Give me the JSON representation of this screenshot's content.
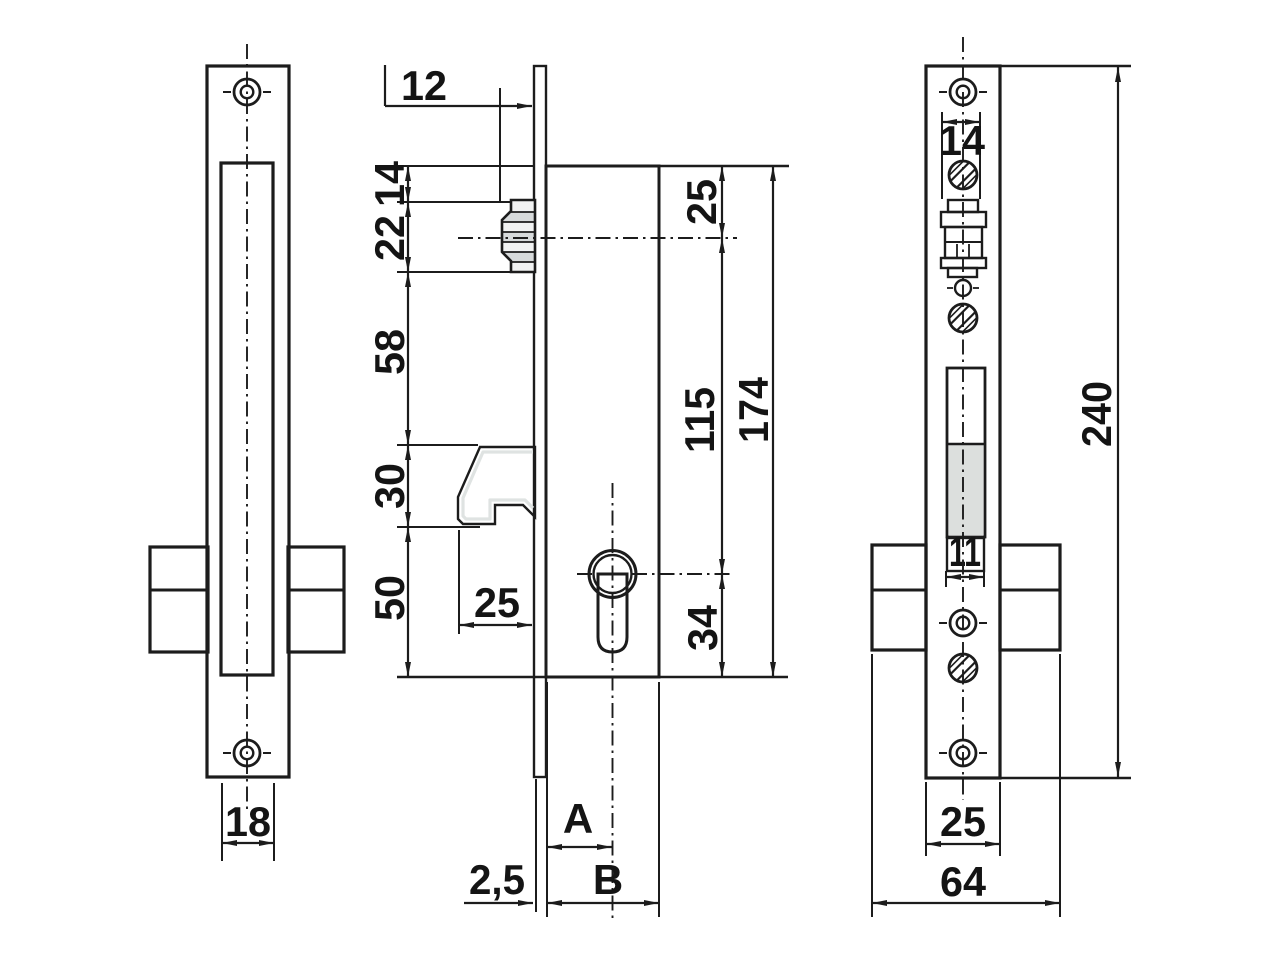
{
  "colors": {
    "plate": "#cdd1d5",
    "plate_edge": "#dde3e0",
    "body": "#67696b",
    "block": "#f0efec",
    "slot_lower": "#dcdfdd",
    "cylinder_inner": "#e4e6e6",
    "roller_stripe": "#d7dadb",
    "roller_fill": "#f2f3f3",
    "hook": "#151515",
    "line": "#1c1c1c",
    "white": "#ffffff"
  },
  "views": {
    "left": {
      "dim_slot_width": "18"
    },
    "middle": {
      "dim_roller_projection": "12",
      "dim_top_to_roller": "14",
      "dim_roller_span": "22",
      "dim_roller_to_hook": "58",
      "dim_hook_height": "30",
      "dim_hook_to_bottom": "50",
      "dim_hook_projection": "25",
      "dim_top_to_axis": "25",
      "dim_axis_to_cylinder": "115",
      "dim_body_height": "174",
      "dim_cylinder_to_bottom": "34",
      "dim_backset": "A",
      "dim_body_depth": "B",
      "dim_plate_thickness": "2,5"
    },
    "right": {
      "dim_roller_width": "14",
      "dim_slot_width": "11",
      "dim_plate_height": "240",
      "dim_plate_width": "25",
      "dim_overall_width": "64"
    }
  }
}
